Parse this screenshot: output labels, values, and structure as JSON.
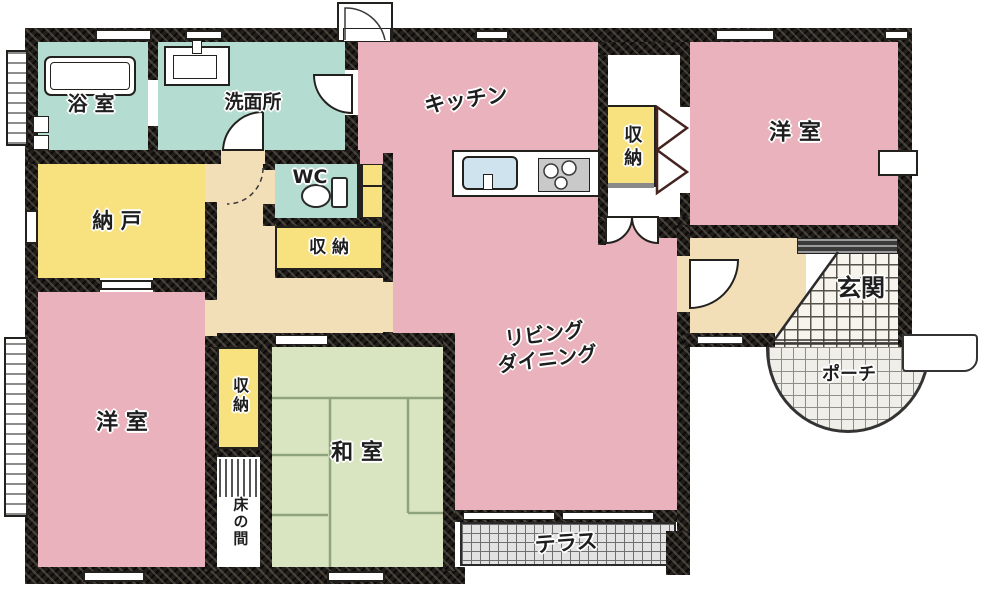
{
  "plan_title": "house-floor-plan",
  "rooms": {
    "bathroom": {
      "label": "浴 室"
    },
    "washroom": {
      "label": "洗面所"
    },
    "kitchen": {
      "label": "キッチン"
    },
    "kitchen_closet": {
      "label": "収納"
    },
    "western_room_upper": {
      "label": "洋 室"
    },
    "wc": {
      "label": "WC"
    },
    "hall_closet": {
      "label": "収 納"
    },
    "storage_room": {
      "label": "納 戸"
    },
    "living_dining": {
      "label": "リビング\nダイニング"
    },
    "entrance": {
      "label": "玄関"
    },
    "porch": {
      "label": "ポーチ"
    },
    "western_room_lower": {
      "label": "洋 室"
    },
    "tatami_closet": {
      "label": "収納"
    },
    "tokonoma": {
      "label": "床の間"
    },
    "japanese_room": {
      "label": "和 室"
    },
    "terrace": {
      "label": "テラス"
    }
  },
  "colors": {
    "room_pink": "#eab2bd",
    "room_teal": "#b5dcd0",
    "room_yellow": "#f8e27f",
    "hall_beige": "#f3dfb7",
    "tatami_green": "#d8e5c0",
    "wall_dark": "#201d1a",
    "tile_line": "#55524b"
  },
  "fixture_symbols": [
    "bathtub",
    "washbasin",
    "toilet",
    "kitchen-sink",
    "stove-burners",
    "shoe-cabinet",
    "folding-closet-doors",
    "door-swings"
  ]
}
